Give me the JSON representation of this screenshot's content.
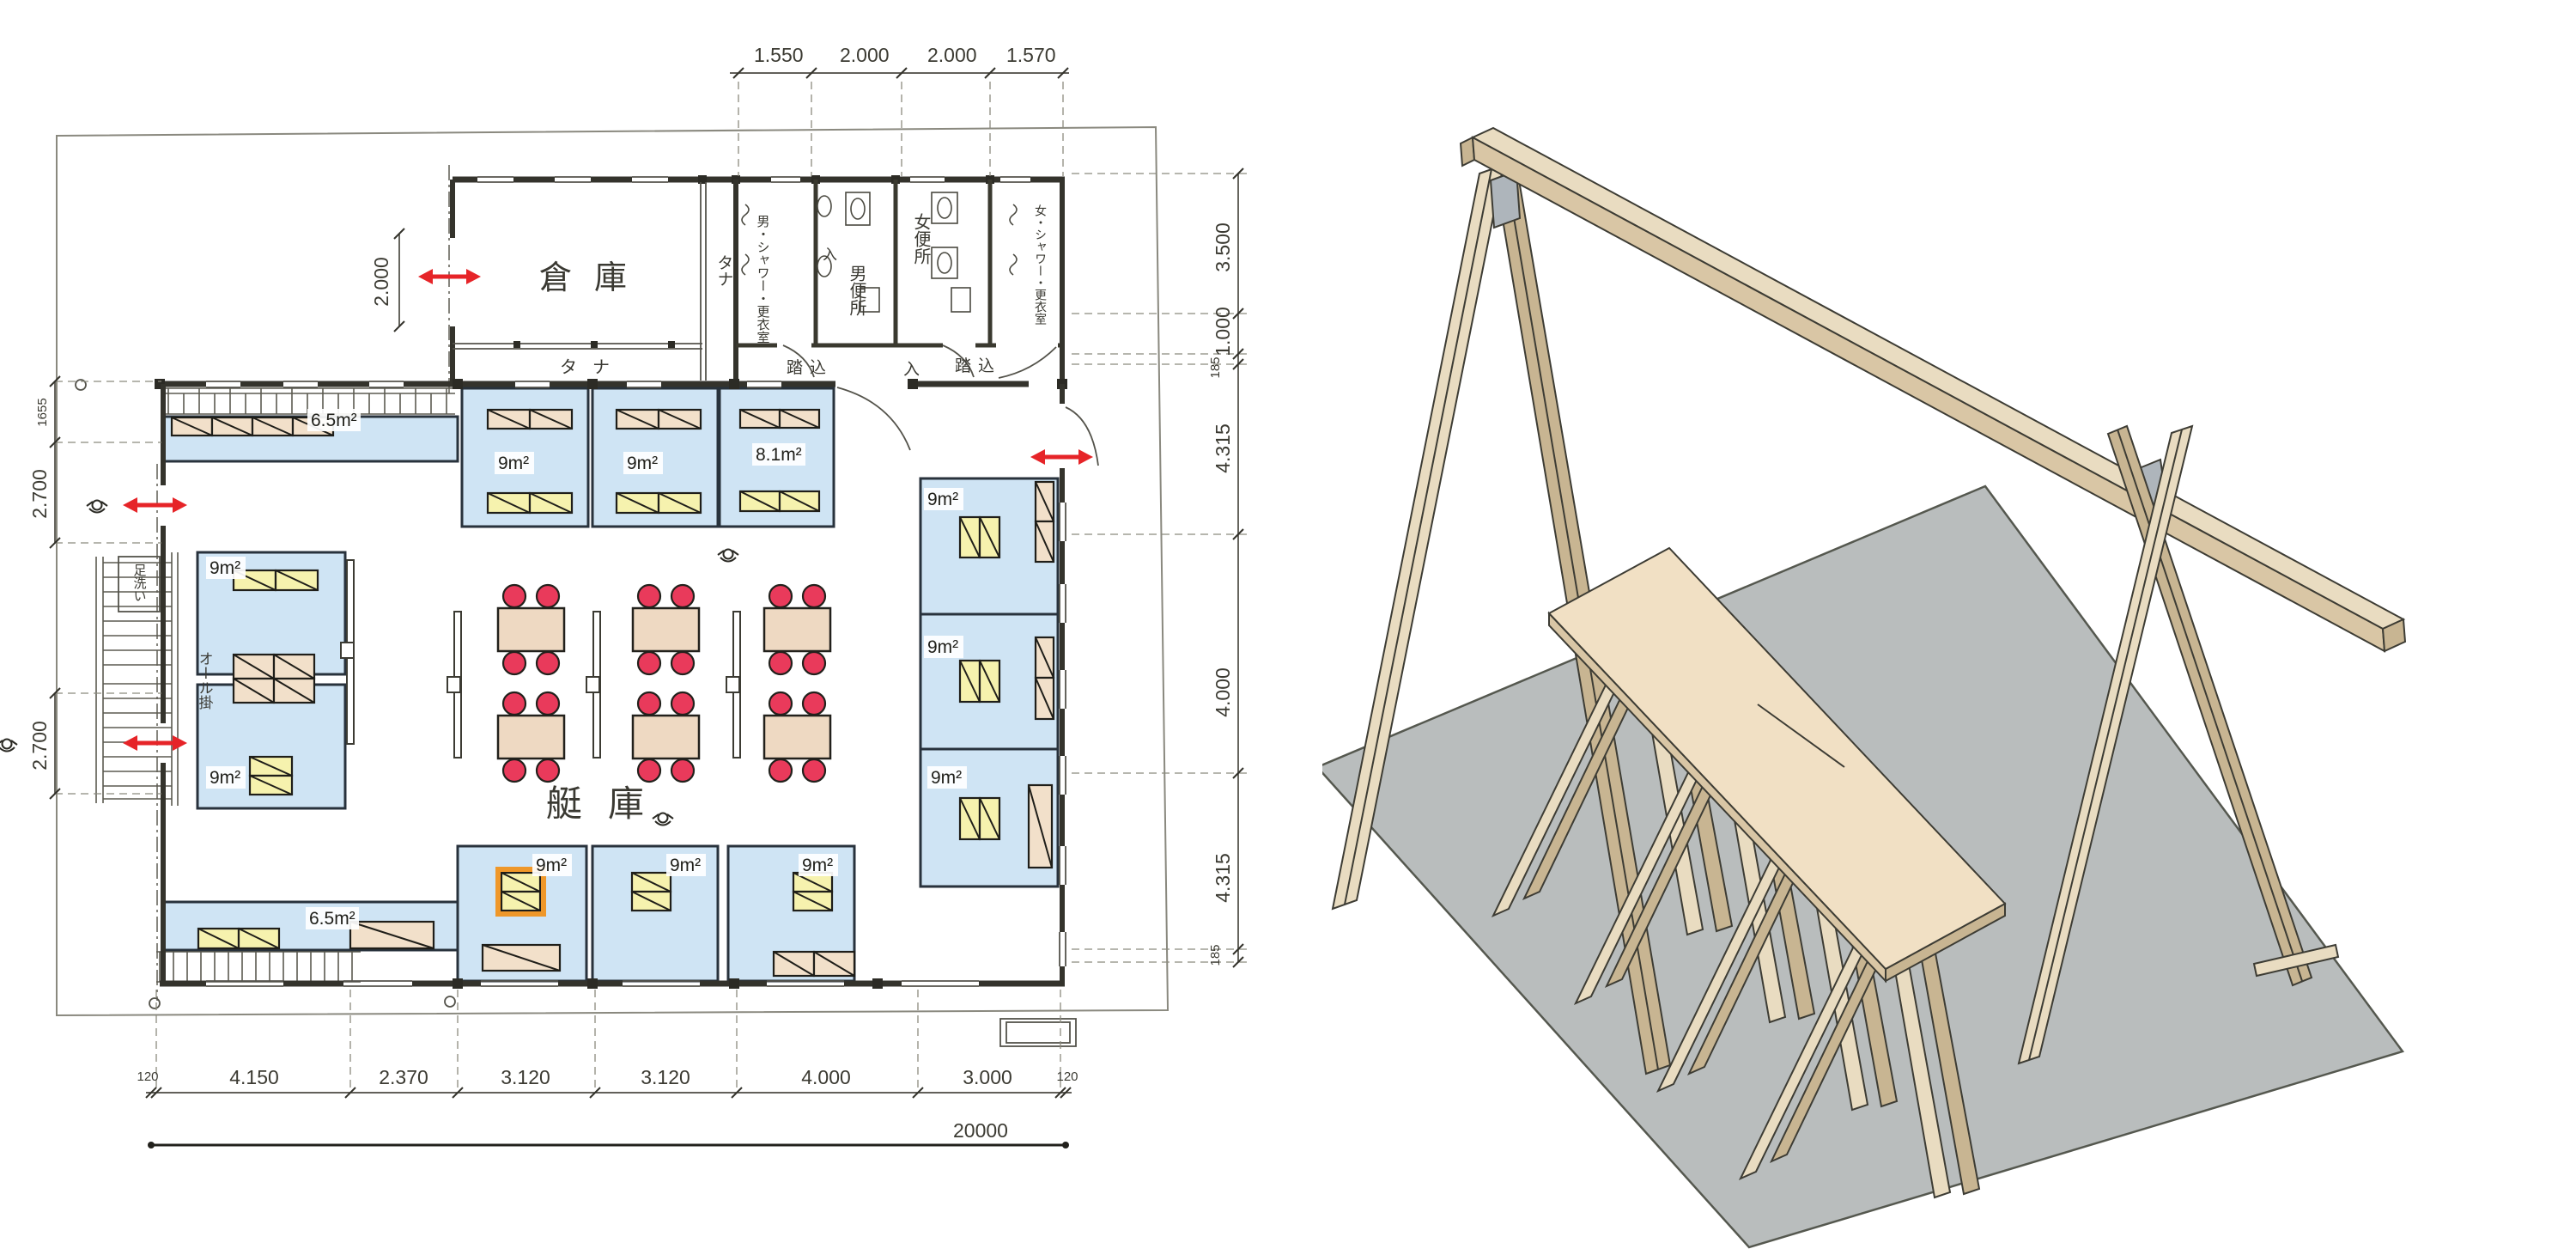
{
  "colors": {
    "room_fill": "#cfe4f4",
    "bed_beige": "#f2e0ca",
    "bed_yellow": "#f6f2ae",
    "bed_highlight": "#ef9729",
    "table_fill": "#eed9c2",
    "chair_red": "#e93a5b",
    "arrow_red": "#e62428",
    "wall_dark": "#34332c",
    "wood_light": "#e9dcc1",
    "wood_dark": "#c8b592",
    "ground_gray": "#b9bdbd",
    "gusset_gray": "#aeb5bb"
  },
  "plan": {
    "rooms": {
      "storage": "倉庫",
      "shelf": "タナ",
      "men_shower": "男・シャワー・更衣室",
      "men_toilet": "男便所",
      "women_toilet": "女便所",
      "women_shower": "女・シャワー・更衣室",
      "entry_step": "踏込",
      "enter": "入",
      "boat_hall": "艇庫",
      "foot_wash": "足洗い",
      "oar_rack": "オール掛"
    },
    "areas": {
      "a9": "9m²",
      "a81": "8.1m²",
      "a65": "6.5m²"
    },
    "dims": {
      "top": [
        "1.550",
        "2.000",
        "2.000",
        "1.570"
      ],
      "right": [
        "3.500",
        "1.000",
        "185",
        "4.315",
        "4.000",
        "4.315",
        "185"
      ],
      "left": [
        "1655",
        "2.700",
        "2.700"
      ],
      "bottom": [
        "120",
        "4.150",
        "2.370",
        "3.120",
        "3.120",
        "4.000",
        "3.000",
        "120"
      ],
      "total": "20000",
      "storage_door": "2.000"
    }
  }
}
